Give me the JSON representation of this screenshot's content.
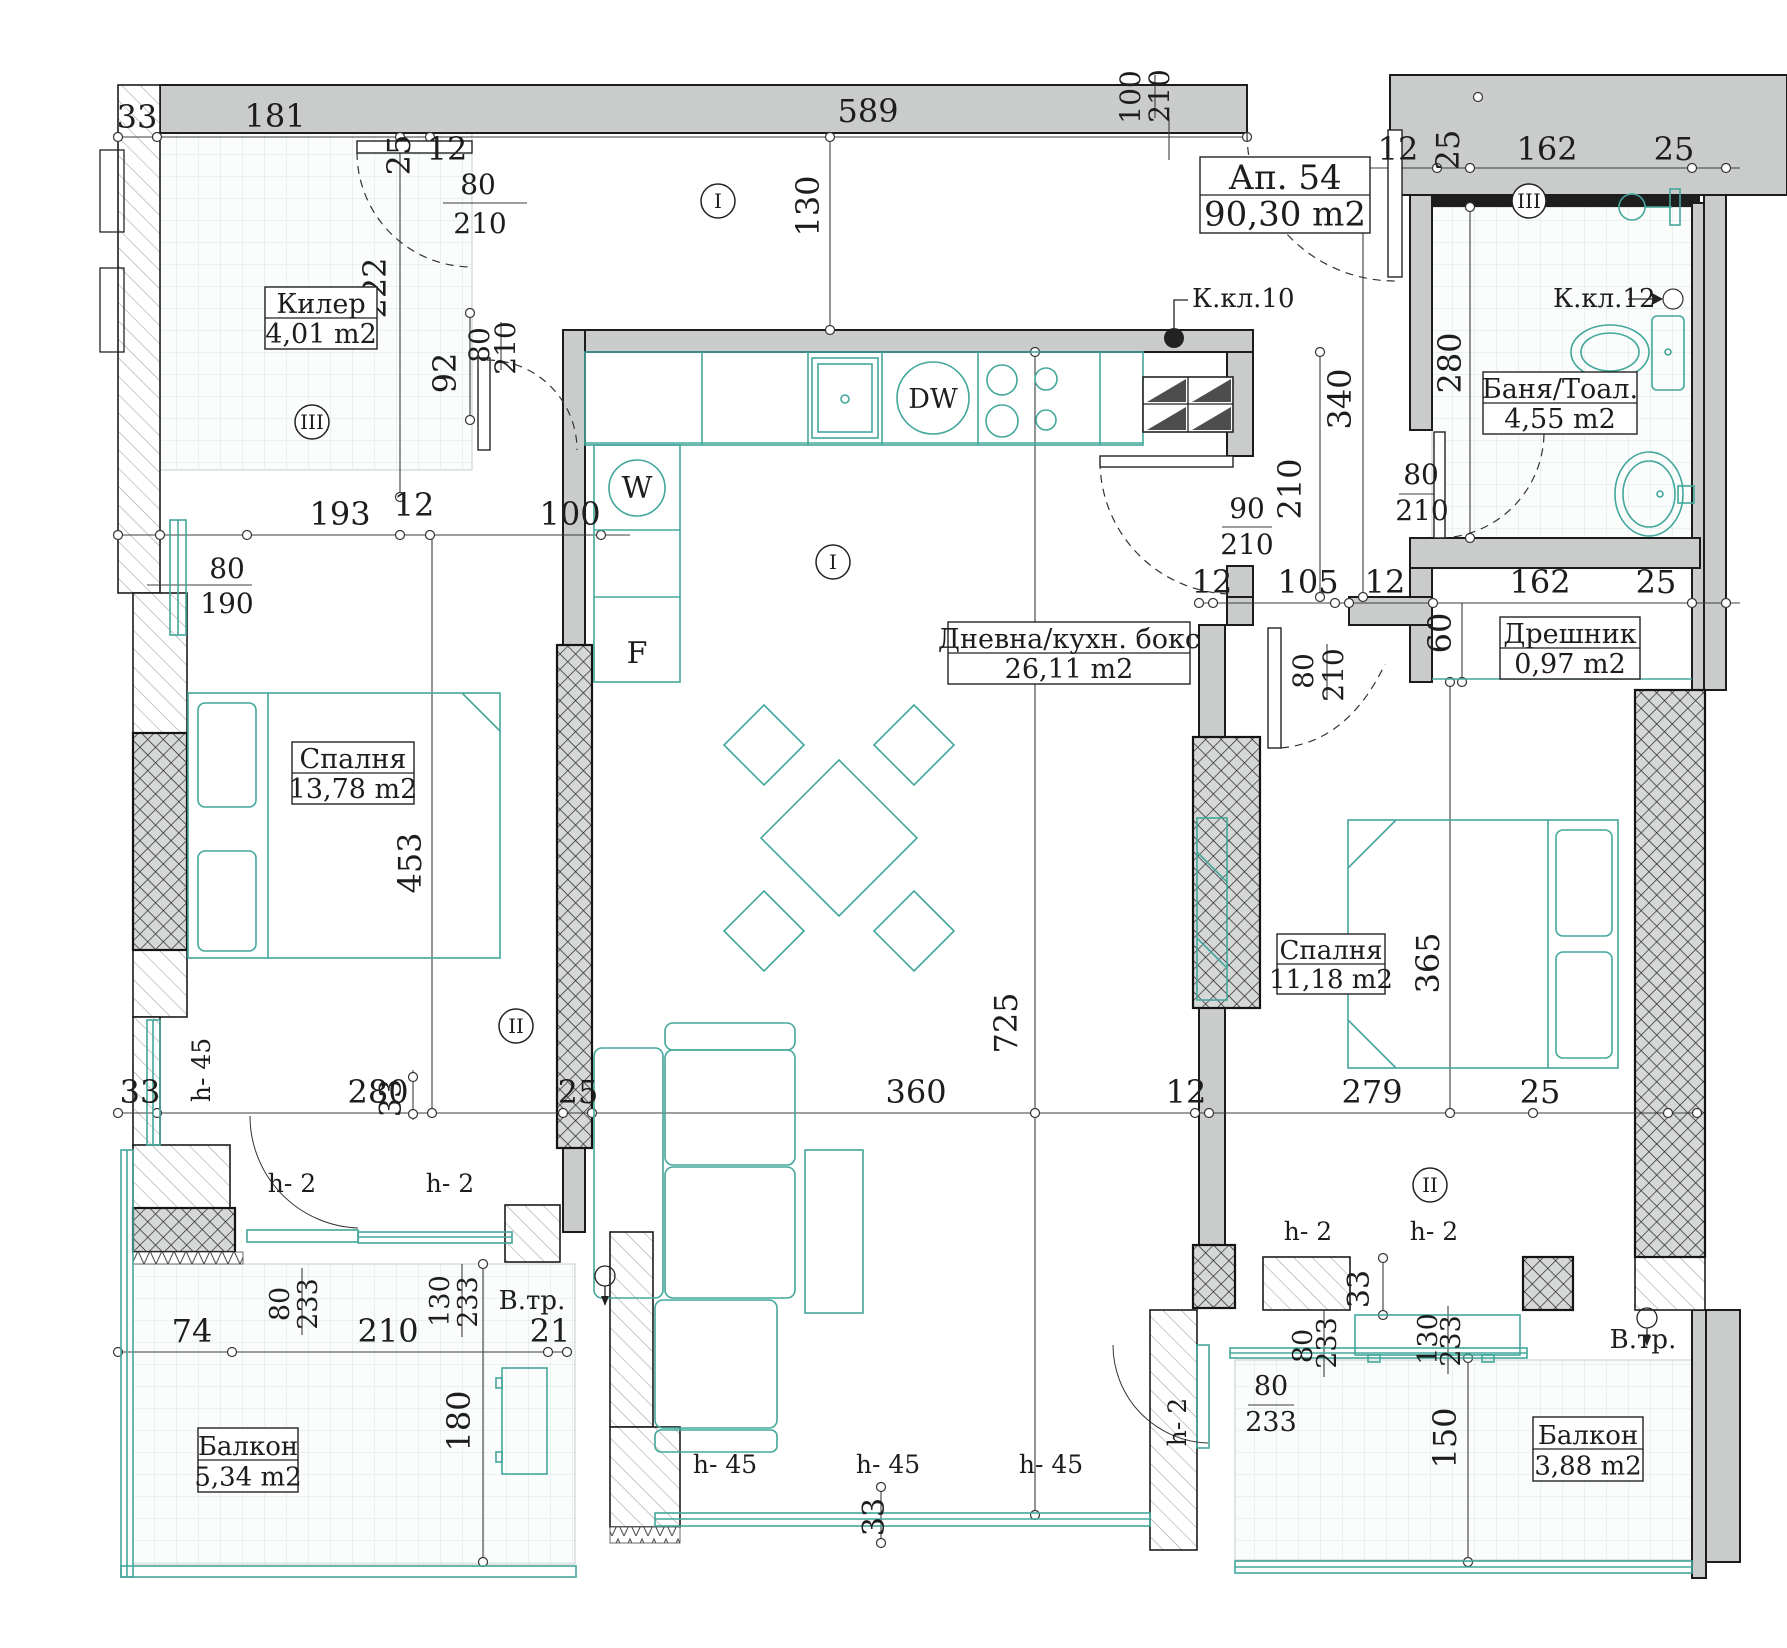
{
  "drawing_title": {
    "number": "Ап. 54",
    "area": "90,30 m2"
  },
  "rooms": [
    {
      "name": "Килер",
      "area": "4,01 m2"
    },
    {
      "name": "Баня/Тоал.",
      "area": "4,55 m2"
    },
    {
      "name": "Дневна/кухн. бокс",
      "area": "26,11 m2"
    },
    {
      "name": "Дрешник",
      "area": "0,97 m2"
    },
    {
      "name": "Спалня",
      "area": "13,78 m2"
    },
    {
      "name": "Спалня",
      "area": "11,18 m2"
    },
    {
      "name": "Балкон",
      "area": "5,34 m2"
    },
    {
      "name": "Балкон",
      "area": "3,88 m2"
    }
  ],
  "room_labels": [
    {
      "name": "Ап. 54",
      "area": "90,30 m2",
      "x": 1200,
      "y": 157,
      "w": 170,
      "h": 76,
      "fs": 34
    },
    {
      "name": "Килер",
      "area": "4,01 m2",
      "x": 265,
      "y": 287,
      "w": 112,
      "h": 62,
      "fs": 27
    },
    {
      "name": "Баня/Тоал.",
      "area": "4,55 m2",
      "x": 1483,
      "y": 372,
      "w": 154,
      "h": 62,
      "fs": 27
    },
    {
      "name": "Дневна/кухн. бокс",
      "area": "26,11 m2",
      "x": 948,
      "y": 622,
      "w": 242,
      "h": 62,
      "fs": 27
    },
    {
      "name": "Дрешник",
      "area": "0,97 m2",
      "x": 1500,
      "y": 617,
      "w": 140,
      "h": 62,
      "fs": 27
    },
    {
      "name": "Спалня",
      "area": "13,78 m2",
      "x": 292,
      "y": 742,
      "w": 122,
      "h": 62,
      "fs": 27
    },
    {
      "name": "Спалня",
      "area": "11,18 m2",
      "x": 1277,
      "y": 934,
      "w": 108,
      "h": 60,
      "fs": 26
    },
    {
      "name": "Балкон",
      "area": "5,34 m2",
      "x": 198,
      "y": 1428,
      "w": 100,
      "h": 64,
      "fs": 26
    },
    {
      "name": "Балкон",
      "area": "3,88 m2",
      "x": 1533,
      "y": 1417,
      "w": 110,
      "h": 64,
      "fs": 26
    }
  ],
  "markers": [
    {
      "t": "I",
      "x": 718,
      "y": 201
    },
    {
      "t": "I",
      "x": 833,
      "y": 562
    },
    {
      "t": "II",
      "x": 516,
      "y": 1026
    },
    {
      "t": "II",
      "x": 1430,
      "y": 1185
    },
    {
      "t": "III",
      "x": 312,
      "y": 422
    },
    {
      "t": "III",
      "x": 1529,
      "y": 201
    }
  ],
  "dimensions": [
    {
      "t": "33",
      "x": 137,
      "y": 128
    },
    {
      "t": "181",
      "x": 275,
      "y": 127
    },
    {
      "t": "25",
      "x": 410,
      "y": 155,
      "r": 1
    },
    {
      "t": "12",
      "x": 447,
      "y": 160
    },
    {
      "t": "589",
      "x": 868,
      "y": 122
    },
    {
      "t": "12",
      "x": 1398,
      "y": 160
    },
    {
      "t": "25",
      "x": 1459,
      "y": 150,
      "r": 1
    },
    {
      "t": "162",
      "x": 1547,
      "y": 160
    },
    {
      "t": "25",
      "x": 1674,
      "y": 160
    },
    {
      "t": "100",
      "x": 1140,
      "y": 97,
      "r": 1,
      "fs": 28
    },
    {
      "t": "210",
      "x": 1169,
      "y": 96,
      "r": 1,
      "fs": 28
    },
    {
      "t": "80",
      "x": 478,
      "y": 194,
      "fs": 28
    },
    {
      "t": "210",
      "x": 480,
      "y": 233,
      "fs": 28
    },
    {
      "t": "222",
      "x": 386,
      "y": 288,
      "r": 1
    },
    {
      "t": "92",
      "x": 456,
      "y": 373,
      "r": 1
    },
    {
      "t": "80",
      "x": 489,
      "y": 345,
      "r": 1,
      "fs": 28
    },
    {
      "t": "210",
      "x": 515,
      "y": 348,
      "r": 1,
      "fs": 28
    },
    {
      "t": "193",
      "x": 340,
      "y": 525
    },
    {
      "t": "12",
      "x": 414,
      "y": 516
    },
    {
      "t": "100",
      "x": 570,
      "y": 525
    },
    {
      "t": "80",
      "x": 227,
      "y": 578,
      "fs": 28
    },
    {
      "t": "190",
      "x": 227,
      "y": 613,
      "fs": 28
    },
    {
      "t": "130",
      "x": 819,
      "y": 206,
      "r": 1
    },
    {
      "t": "453",
      "x": 421,
      "y": 863,
      "r": 1
    },
    {
      "t": "725",
      "x": 1017,
      "y": 1023,
      "r": 1
    },
    {
      "t": "340",
      "x": 1351,
      "y": 399,
      "r": 1
    },
    {
      "t": "280",
      "x": 1461,
      "y": 363,
      "r": 1
    },
    {
      "t": "210",
      "x": 1301,
      "y": 489,
      "r": 1
    },
    {
      "t": "90",
      "x": 1247,
      "y": 518,
      "fs": 28
    },
    {
      "t": "210",
      "x": 1247,
      "y": 554,
      "fs": 28
    },
    {
      "t": "12",
      "x": 1212,
      "y": 593
    },
    {
      "t": "105",
      "x": 1308,
      "y": 593
    },
    {
      "t": "12",
      "x": 1385,
      "y": 593
    },
    {
      "t": "162",
      "x": 1540,
      "y": 593
    },
    {
      "t": "25",
      "x": 1656,
      "y": 593
    },
    {
      "t": "60",
      "x": 1451,
      "y": 633,
      "r": 1
    },
    {
      "t": "80",
      "x": 1313,
      "y": 671,
      "r": 1,
      "fs": 28
    },
    {
      "t": "210",
      "x": 1343,
      "y": 675,
      "r": 1,
      "fs": 28
    },
    {
      "t": "80",
      "x": 1421,
      "y": 484,
      "fs": 28
    },
    {
      "t": "210",
      "x": 1422,
      "y": 520,
      "fs": 28
    },
    {
      "t": "365",
      "x": 1439,
      "y": 963,
      "r": 1
    },
    {
      "t": "150",
      "x": 1456,
      "y": 1438,
      "r": 1
    },
    {
      "t": "33",
      "x": 140,
      "y": 1103
    },
    {
      "t": "280",
      "x": 378,
      "y": 1103
    },
    {
      "t": "25",
      "x": 578,
      "y": 1103
    },
    {
      "t": "360",
      "x": 916,
      "y": 1103
    },
    {
      "t": "12",
      "x": 1186,
      "y": 1103
    },
    {
      "t": "279",
      "x": 1372,
      "y": 1103
    },
    {
      "t": "25",
      "x": 1540,
      "y": 1103
    },
    {
      "t": "33",
      "x": 401,
      "y": 1098,
      "r": 1,
      "fs": 30
    },
    {
      "t": "33",
      "x": 1369,
      "y": 1289,
      "r": 1,
      "fs": 30
    },
    {
      "t": "33",
      "x": 884,
      "y": 1517,
      "r": 1,
      "fs": 30
    },
    {
      "t": "74",
      "x": 192,
      "y": 1342
    },
    {
      "t": "210",
      "x": 388,
      "y": 1342
    },
    {
      "t": "21",
      "x": 550,
      "y": 1342
    },
    {
      "t": "180",
      "x": 470,
      "y": 1421,
      "r": 1
    },
    {
      "t": "80",
      "x": 289,
      "y": 1304,
      "r": 1,
      "fs": 27
    },
    {
      "t": "233",
      "x": 317,
      "y": 1304,
      "r": 1,
      "fs": 27
    },
    {
      "t": "130",
      "x": 449,
      "y": 1301,
      "r": 1,
      "fs": 27
    },
    {
      "t": "233",
      "x": 477,
      "y": 1302,
      "r": 1,
      "fs": 27
    },
    {
      "t": "80",
      "x": 1312,
      "y": 1346,
      "r": 1,
      "fs": 27
    },
    {
      "t": "233",
      "x": 1336,
      "y": 1343,
      "r": 1,
      "fs": 27
    },
    {
      "t": "130",
      "x": 1437,
      "y": 1339,
      "r": 1,
      "fs": 27
    },
    {
      "t": "233",
      "x": 1460,
      "y": 1341,
      "r": 1,
      "fs": 27
    },
    {
      "t": "80",
      "x": 1271,
      "y": 1395,
      "fs": 27
    },
    {
      "t": "233",
      "x": 1271,
      "y": 1431,
      "fs": 27
    }
  ],
  "annotations": [
    {
      "t": "К.кл.10",
      "x": 1192,
      "y": 307,
      "a": "start",
      "fs": 26,
      "n": "kitchen-riser-label"
    },
    {
      "t": "К.кл.12",
      "x": 1553,
      "y": 307,
      "a": "start",
      "fs": 26,
      "n": "bath-riser-label"
    },
    {
      "t": "В.тр.",
      "x": 532,
      "y": 1309,
      "fs": 26,
      "n": "vent-shaft-label"
    },
    {
      "t": "В.тр.",
      "x": 1643,
      "y": 1348,
      "fs": 26,
      "n": "vent-shaft-label"
    },
    {
      "t": "h- 2",
      "x": 292,
      "y": 1192,
      "fs": 25,
      "n": "sill-height-label"
    },
    {
      "t": "h- 2",
      "x": 450,
      "y": 1192,
      "fs": 25,
      "n": "sill-height-label"
    },
    {
      "t": "h- 2",
      "x": 1308,
      "y": 1240,
      "fs": 25,
      "n": "sill-height-label"
    },
    {
      "t": "h- 2",
      "x": 1434,
      "y": 1240,
      "fs": 25,
      "n": "sill-height-label"
    },
    {
      "t": "h- 2",
      "x": 1186,
      "y": 1422,
      "r": 1,
      "fs": 25,
      "n": "sill-height-label"
    },
    {
      "t": "h- 45",
      "x": 210,
      "y": 1070,
      "r": 1,
      "fs": 25,
      "n": "sill-height-label"
    },
    {
      "t": "h- 45",
      "x": 725,
      "y": 1473,
      "fs": 25,
      "n": "sill-height-label"
    },
    {
      "t": "h- 45",
      "x": 888,
      "y": 1473,
      "fs": 25,
      "n": "sill-height-label"
    },
    {
      "t": "h- 45",
      "x": 1051,
      "y": 1473,
      "fs": 25,
      "n": "sill-height-label"
    },
    {
      "t": "W",
      "x": 637,
      "y": 498,
      "fs": 30,
      "c": "#43a79c",
      "n": "washer-label"
    },
    {
      "t": "F",
      "x": 637,
      "y": 663,
      "fs": 30,
      "c": "#43a79c",
      "n": "fridge-label"
    },
    {
      "t": "DW",
      "x": 933,
      "y": 408,
      "fs": 27,
      "c": "#43a79c",
      "n": "dishwasher-label"
    }
  ],
  "colors": {
    "wall": "#cacccc",
    "accent_teal": "#43a79c",
    "line": "#1c1c1c"
  }
}
